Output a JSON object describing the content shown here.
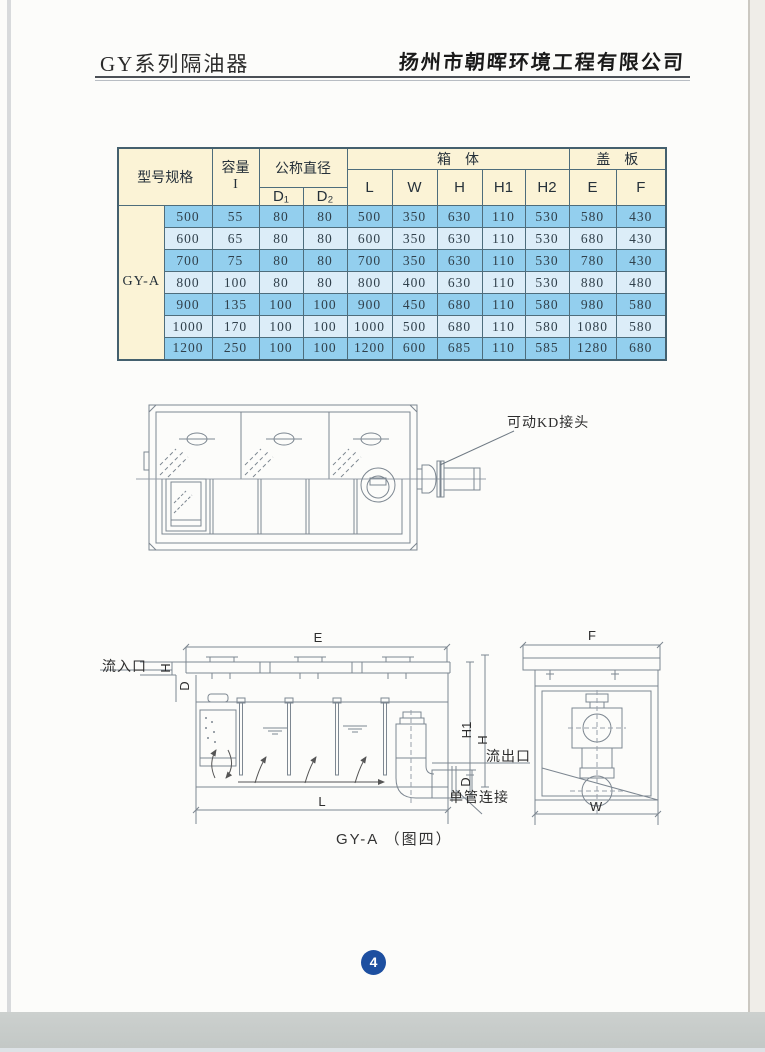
{
  "header": {
    "title": "GY系列隔油器",
    "company": "扬州市朝晖环境工程有限公司"
  },
  "table": {
    "model_header": "型号规格",
    "capacity_line1": "容量",
    "capacity_line2": "I",
    "nominal_diameter": "公称直径",
    "d1": "D₁",
    "d2": "D₂",
    "box_header": "箱　体",
    "cover_header": "盖　板",
    "cols": {
      "L": "L",
      "W": "W",
      "H": "H",
      "H1": "H1",
      "H2": "H2",
      "E": "E",
      "F": "F"
    },
    "model": "GY-A",
    "rows": [
      [
        "500",
        "55",
        "80",
        "80",
        "500",
        "350",
        "630",
        "110",
        "530",
        "580",
        "430"
      ],
      [
        "600",
        "65",
        "80",
        "80",
        "600",
        "350",
        "630",
        "110",
        "530",
        "680",
        "430"
      ],
      [
        "700",
        "75",
        "80",
        "80",
        "700",
        "350",
        "630",
        "110",
        "530",
        "780",
        "430"
      ],
      [
        "800",
        "100",
        "80",
        "80",
        "800",
        "400",
        "630",
        "110",
        "530",
        "880",
        "480"
      ],
      [
        "900",
        "135",
        "100",
        "100",
        "900",
        "450",
        "680",
        "110",
        "580",
        "980",
        "580"
      ],
      [
        "1000",
        "170",
        "100",
        "100",
        "1000",
        "500",
        "680",
        "110",
        "580",
        "1080",
        "580"
      ],
      [
        "1200",
        "250",
        "100",
        "100",
        "1200",
        "600",
        "685",
        "110",
        "585",
        "1280",
        "680"
      ]
    ]
  },
  "figure_top": {
    "kd_joint_label": "可动KD接头"
  },
  "figure_bottom": {
    "inlet_label": "流入口",
    "outlet_label": "流出口",
    "single_pipe_label": "单管连接",
    "caption": "GY-A （图四）",
    "dims": {
      "E": "E",
      "L": "L",
      "H": "H",
      "H1": "H1",
      "D": "D",
      "F": "F",
      "W": "W"
    }
  },
  "page": {
    "number": "4"
  },
  "colors": {
    "row_blue": "#93cfee",
    "row_light": "#dcedf8",
    "header_cream": "#fbf3d6",
    "page_badge_blue": "#1d4fa0"
  }
}
